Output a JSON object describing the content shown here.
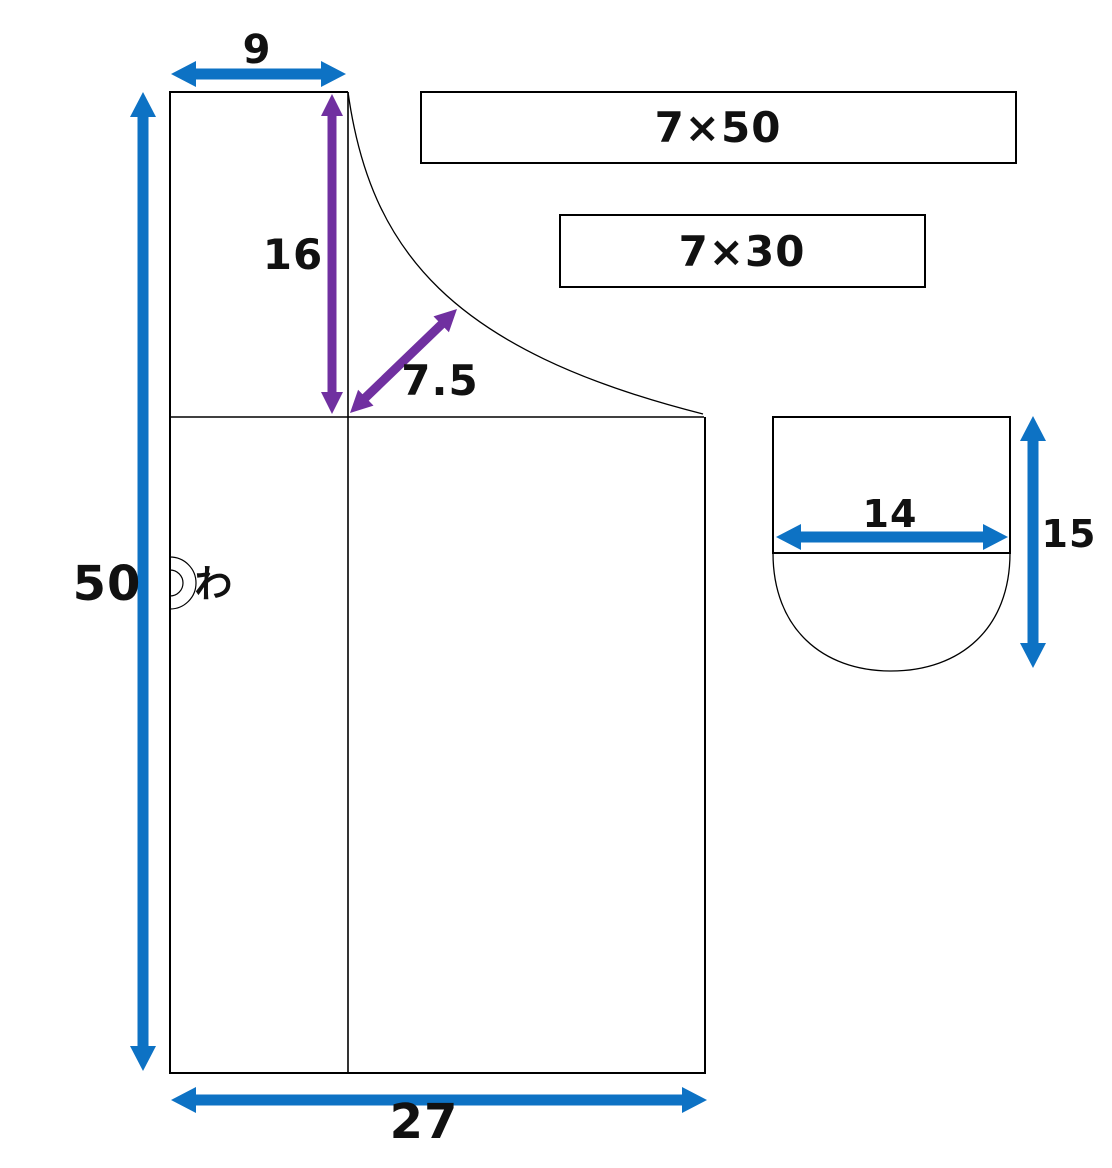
{
  "pattern": {
    "body_piece": {
      "strap_width": "9",
      "neck_depth": "16",
      "neck_curve_depth": "7.5",
      "length": "50",
      "width": "27",
      "fold_mark": "わ"
    },
    "tie_pieces": {
      "long_tie": "7×50",
      "short_tie": "7×30"
    },
    "pocket_piece": {
      "width": "14",
      "height": "15"
    },
    "colors": {
      "dimension_blue": "#0D72C4",
      "dimension_purple": "#7030A0",
      "outline": "#000000",
      "background": "#FFFFFF"
    }
  }
}
